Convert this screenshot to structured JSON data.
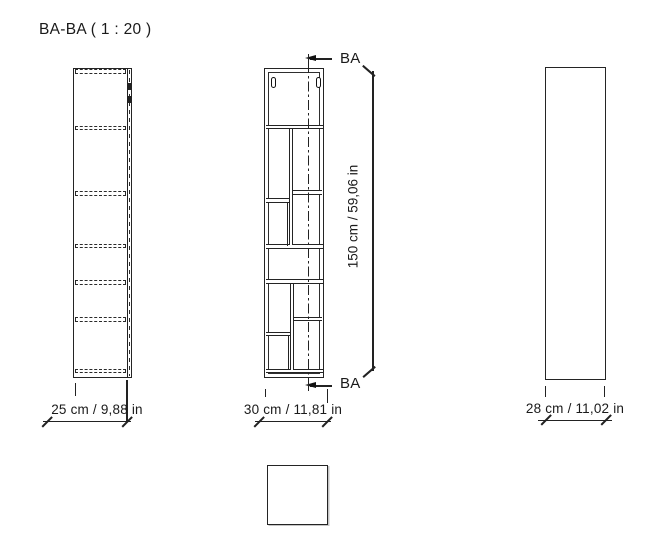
{
  "title": "BA-BA ( 1 : 20 )",
  "section_marks": {
    "top_label": "BA",
    "bottom_label": "BA"
  },
  "dimensions": {
    "section_width": "25 cm / 9,88 in",
    "front_width": "30 cm / 11,81 in",
    "height": "150 cm / 59,06 in",
    "side_depth": "28 cm / 11,02 in"
  },
  "colors": {
    "line": "#222222",
    "background": "#ffffff",
    "text": "#1a1a1a"
  }
}
